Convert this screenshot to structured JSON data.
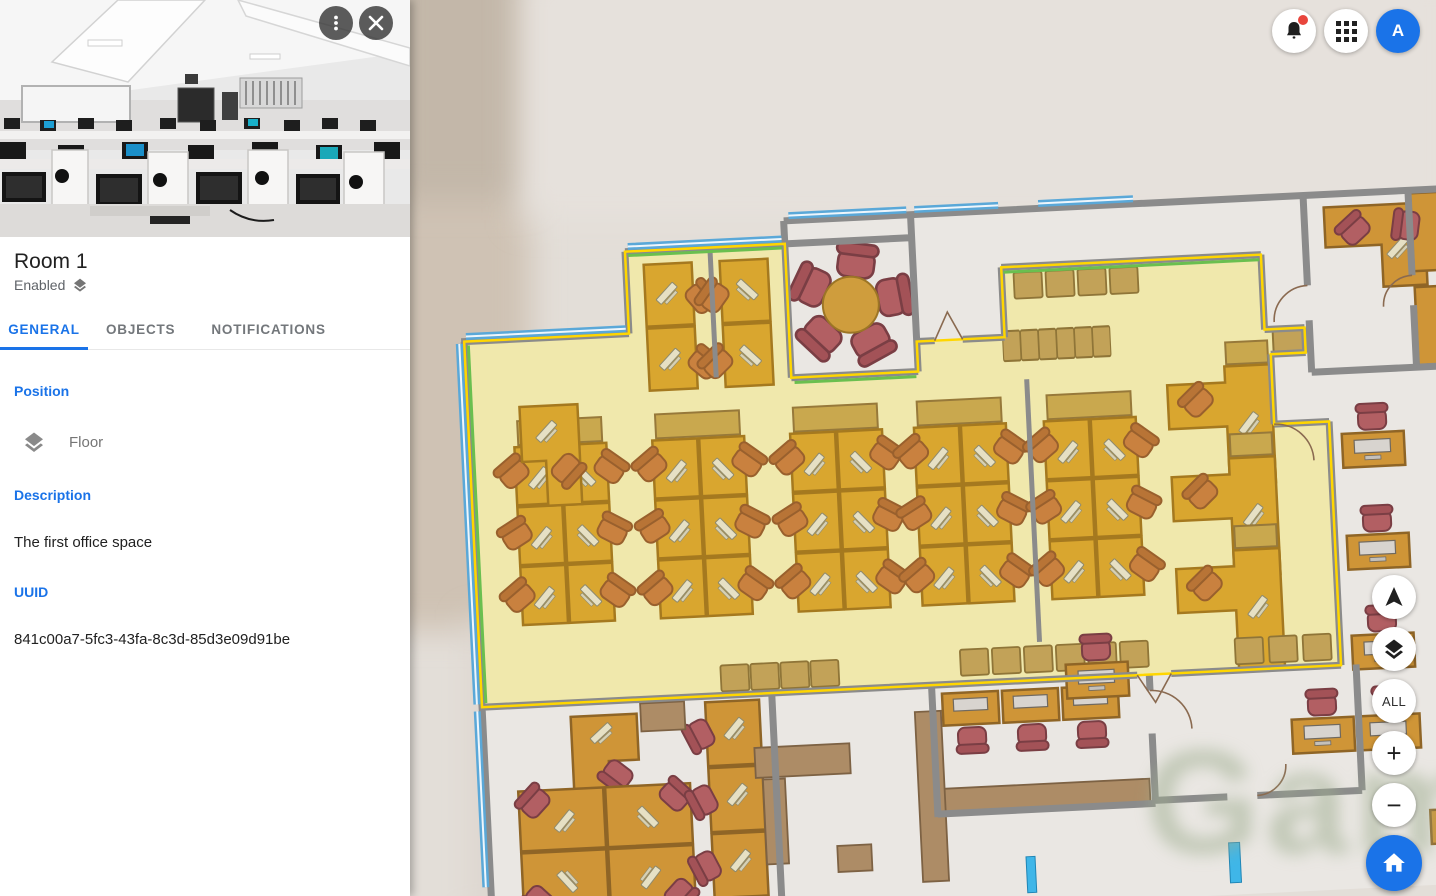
{
  "panel": {
    "title": "Room 1",
    "status": "Enabled",
    "tabs": [
      {
        "label": "GENERAL",
        "active": true
      },
      {
        "label": "OBJECTS",
        "active": false
      },
      {
        "label": "NOTIFICATIONS",
        "active": false
      }
    ],
    "sections": {
      "position": {
        "label": "Position",
        "value": "Floor"
      },
      "description": {
        "label": "Description",
        "value": "The first office space"
      },
      "uuid": {
        "label": "UUID",
        "value": "841c00a7-5fc3-43fa-8c3d-85d3e09d91be"
      }
    },
    "icons": [
      "more-vert-kebab",
      "close-x",
      "layers-badge"
    ]
  },
  "topbar": {
    "avatar_letter": "A",
    "icons": [
      "notifications-bell-with-dot",
      "apps-grid",
      "account-avatar"
    ]
  },
  "map": {
    "controls": {
      "all_label": "ALL",
      "zoom_in_label": "+",
      "zoom_out_label": "−",
      "icons": [
        "compass-arrow",
        "layers",
        "home"
      ]
    },
    "watermark": "Game",
    "selected_room": "Room 1"
  },
  "colors": {
    "accent_blue": "#1a73e8",
    "notification_red": "#e8453c",
    "room_highlight_fill": "#f0e8ac",
    "room_highlight_border": "#ffd600",
    "window_blue": "#5aa8d8",
    "accent_green": "#6abf4f",
    "desk_orange": "#d9a62f",
    "chair_orange": "#c9813f",
    "chair_maroon": "#b25f63",
    "wall_gray": "#8b8b8b",
    "counter_brown": "#ad8c66"
  }
}
